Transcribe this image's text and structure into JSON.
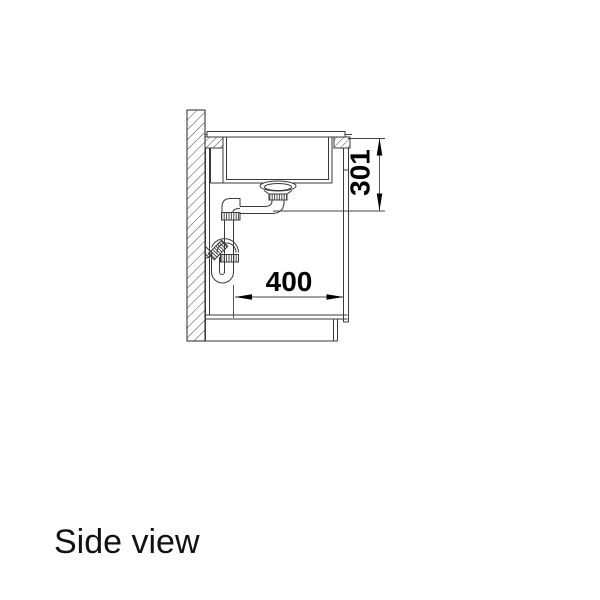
{
  "drawing": {
    "title": "Side view",
    "width_label": "400",
    "height_label": "301",
    "line_color": "#3a3a3a",
    "background_color": "#ffffff",
    "text_color": "#000000"
  }
}
